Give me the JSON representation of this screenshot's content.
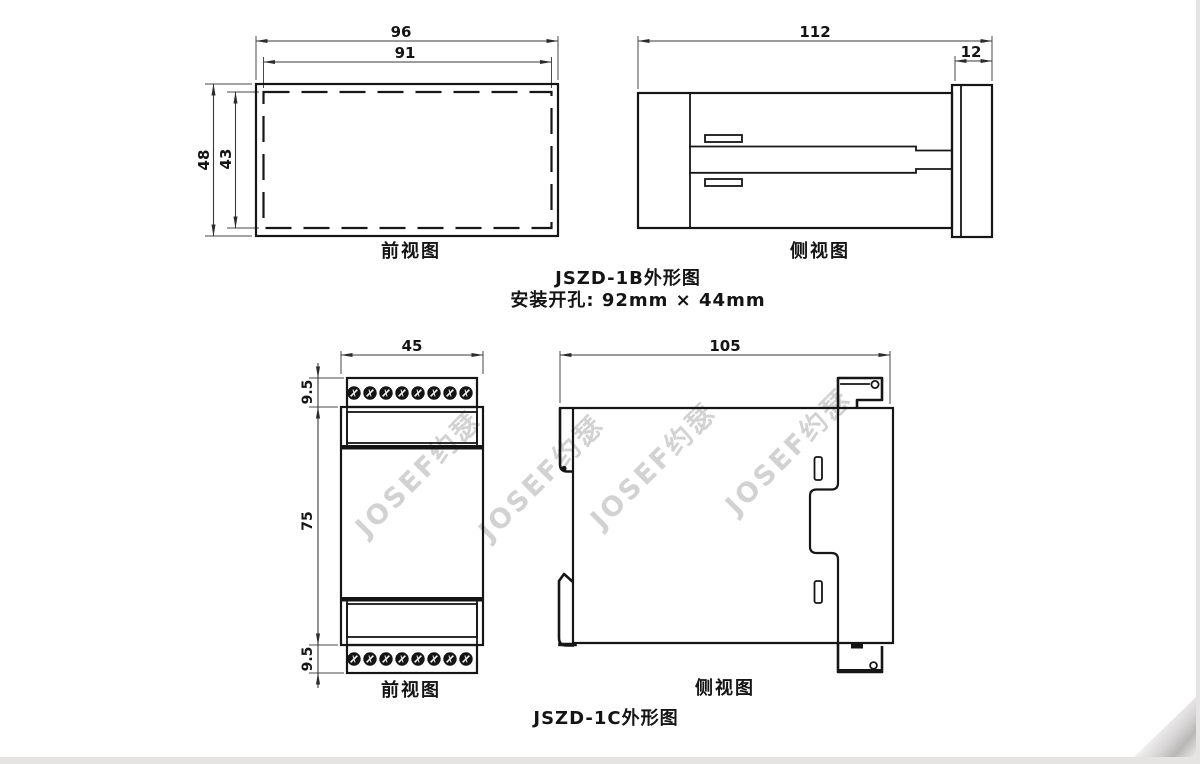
{
  "watermark": {
    "text": "JOSEF约瑟"
  },
  "jszd1b": {
    "front": {
      "label": "前视图",
      "dim_outer_width": "96",
      "dim_inner_width": "91",
      "dim_outer_height": "48",
      "dim_inner_height": "43"
    },
    "side": {
      "label": "侧视图",
      "dim_depth": "112",
      "dim_panel": "12"
    },
    "caption": {
      "title": "JSZD-1B外形图",
      "mounting": "安装开孔: 92mm × 44mm"
    }
  },
  "jszd1c": {
    "front": {
      "label": "前视图",
      "dim_width": "45",
      "dim_top": "9.5",
      "dim_body": "75",
      "dim_bottom": "9.5"
    },
    "side": {
      "label": "侧视图",
      "dim_depth": "105"
    },
    "caption": {
      "title": "JSZD-1C外形图"
    }
  }
}
